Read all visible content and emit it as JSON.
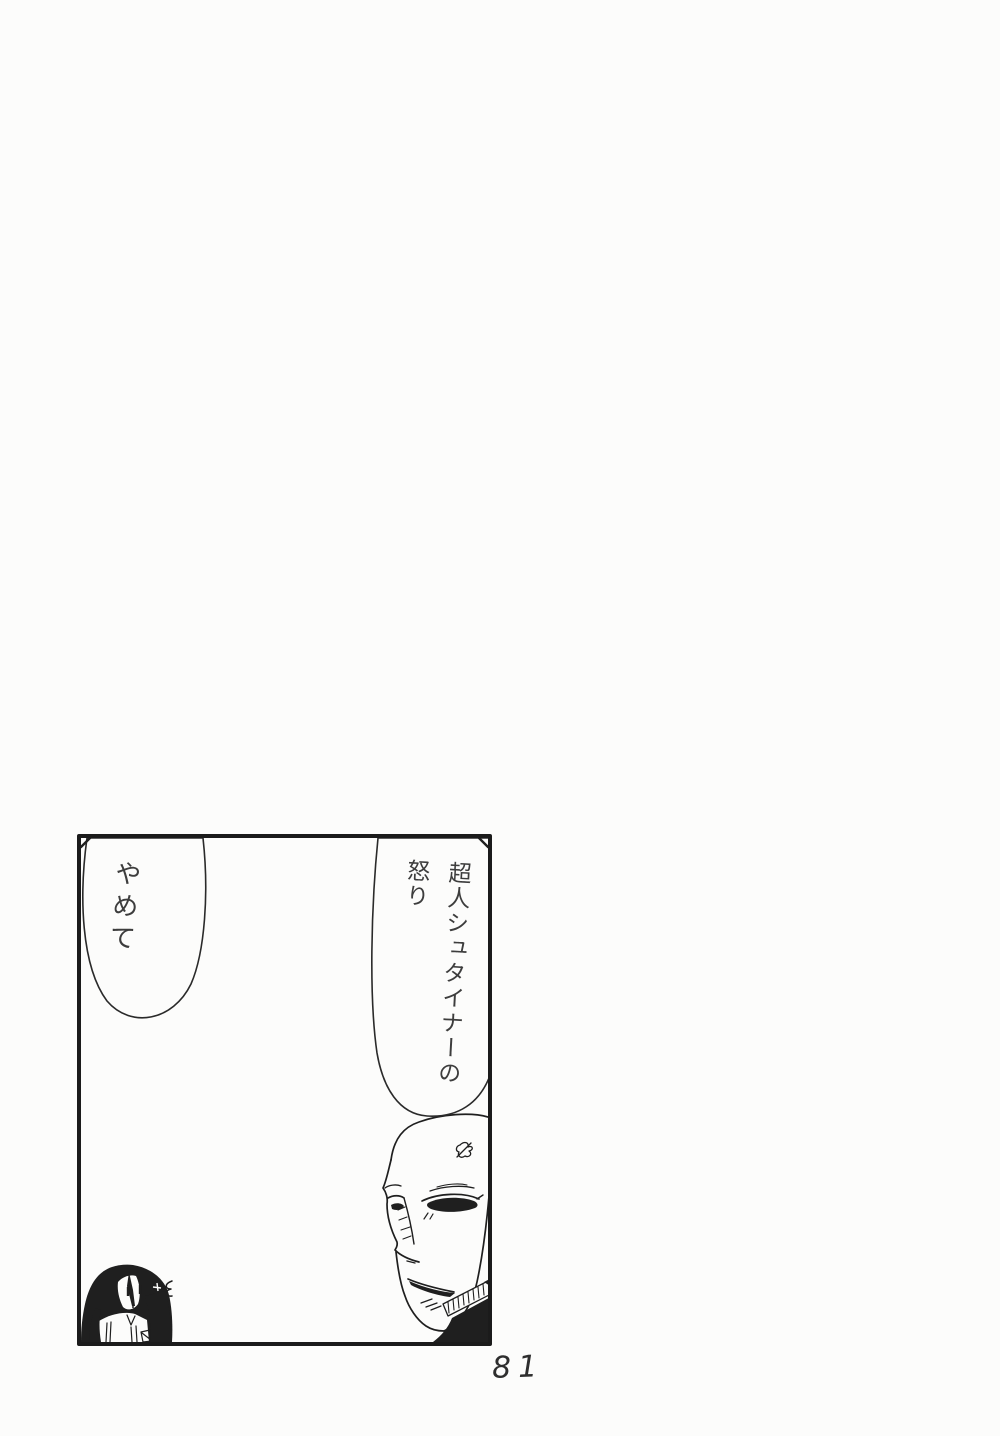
{
  "page": {
    "number_label": "81",
    "paper_color": "#fcfcfb",
    "ink_color": "#1f1f1f"
  },
  "panel": {
    "speech_bubble_left": {
      "text": "やめて"
    },
    "speech_bubble_right": {
      "line1": "超人シュタイナーの",
      "line2": "怒り"
    }
  }
}
